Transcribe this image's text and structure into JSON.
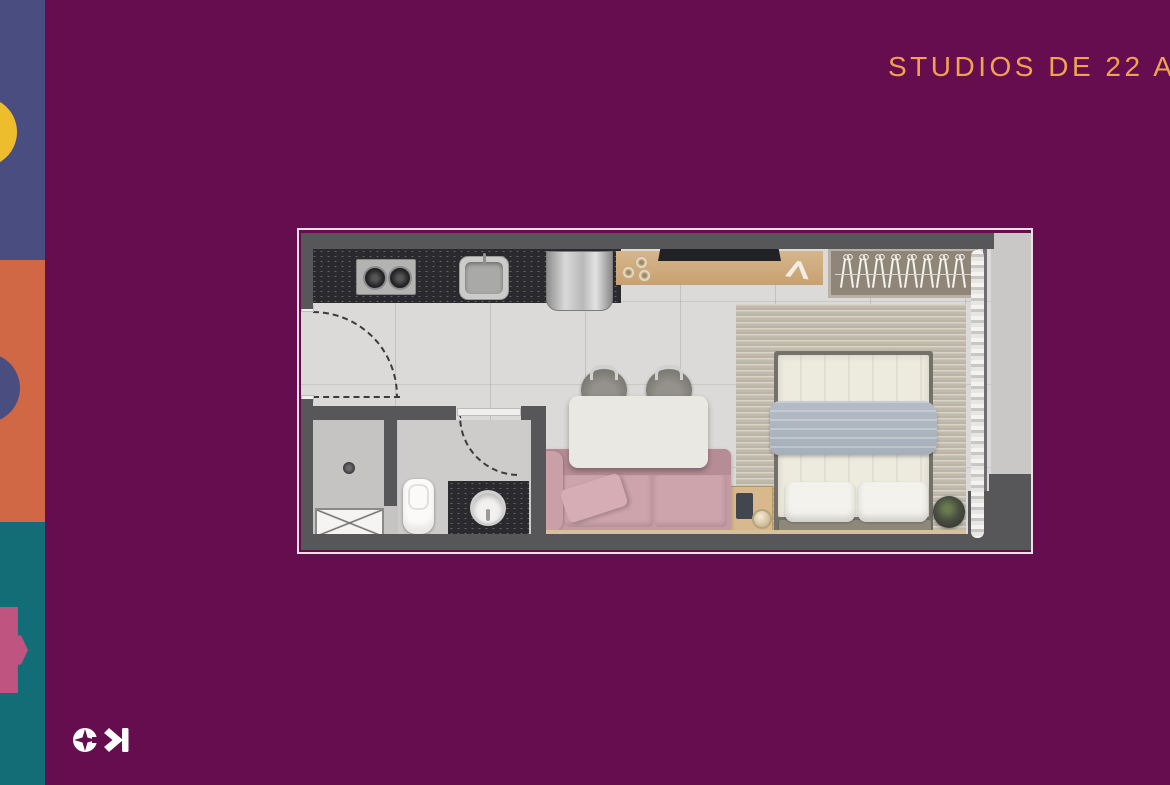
{
  "header": {
    "title": "STUDIOS DE 22 A"
  },
  "palette": {
    "background": "#650d4f",
    "accent": "#f0a24f",
    "sidebar_blue": "#494d7f",
    "sidebar_orange": "#d06845",
    "sidebar_teal": "#136d76",
    "shape_yellow": "#eebd2e",
    "shape_pink": "#c05480",
    "plan_outline": "#ecdfe8",
    "wall": "#57575a",
    "floor": "#dbdad8",
    "outdoor": "#c9c8c6",
    "counter": "#2a2a2e",
    "rug": "#c8c0b1",
    "duvet": "#edeade",
    "blanket": "#a6b0ba",
    "sofa": "#c49aa3",
    "table": "#eae8e3",
    "logo_color": "#ffffff"
  },
  "floorplan": {
    "wardrobe": {
      "hanger_count": 16
    }
  }
}
